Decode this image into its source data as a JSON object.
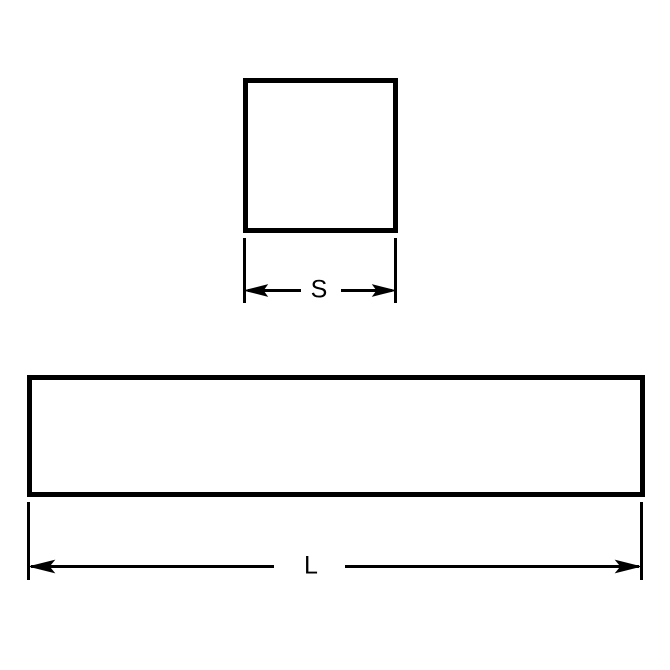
{
  "diagram": {
    "type": "engineering-dimension-drawing",
    "colors": {
      "line": "#000000",
      "background": "#ffffff"
    },
    "square_view": {
      "description": "square cross-section",
      "dimension_label": "S"
    },
    "bar_view": {
      "description": "bar length side view",
      "dimension_label": "L"
    }
  }
}
